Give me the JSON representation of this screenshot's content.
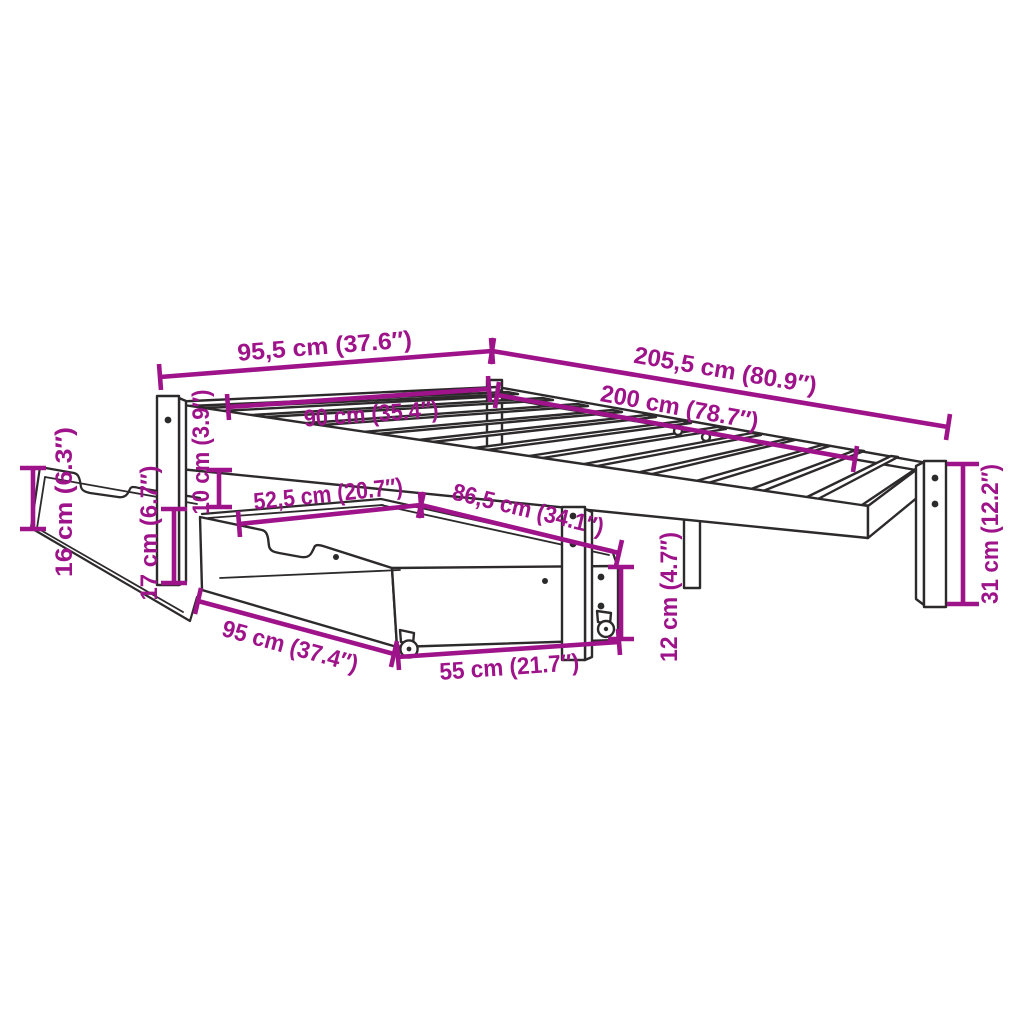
{
  "diagram": {
    "colors": {
      "dimension": "#9e1389",
      "line": "#2d2a2b",
      "background": "#ffffff"
    },
    "dimensions": {
      "outer_width": "95,5 cm (37.6″)",
      "outer_length": "205,5 cm (80.9″)",
      "inner_width": "90 cm (35.4″)",
      "inner_length": "200 cm (78.7″)",
      "clearance_height": "10 cm (3.9″)",
      "drawer_back_height": "16 cm (6.3″)",
      "drawer_front_height": "17 cm (6.7″)",
      "drawer_offset": "52,5 cm (20.7″)",
      "under_bed_span": "86,5 cm (34.1″)",
      "drawer_side_height": "12 cm (4.7″)",
      "drawer_width": "95 cm (37.4″)",
      "drawer_depth": "55 cm (21.7″)",
      "leg_height": "31 cm (12.2″)"
    }
  }
}
